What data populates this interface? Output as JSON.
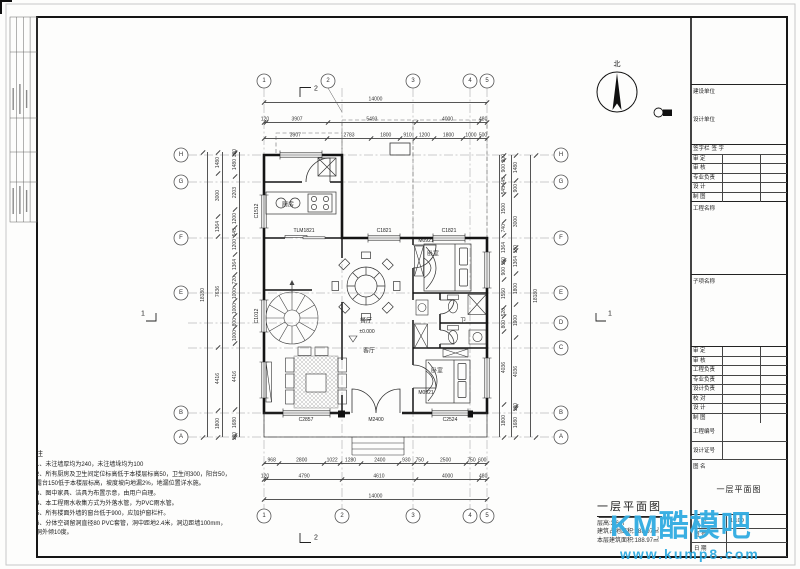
{
  "north_label": "北",
  "section_marks": {
    "top": "2",
    "bottom": "2",
    "left": "1",
    "right": "1"
  },
  "grid": {
    "top": [
      "1",
      "2",
      "3",
      "4",
      "5"
    ],
    "bottom": [
      "1",
      "2",
      "3",
      "4",
      "5"
    ],
    "left": [
      "H",
      "G",
      "F",
      "E",
      "B",
      "A"
    ],
    "right": [
      "H",
      "G",
      "F",
      "E",
      "D",
      "C",
      "B",
      "A"
    ]
  },
  "dims": {
    "top1": [
      "14000"
    ],
    "top2": [
      "120",
      "3907",
      "5493",
      "4000",
      "480"
    ],
    "top3": [
      "3907",
      "2783",
      "1800",
      "910",
      "1200",
      "1800",
      "1000",
      "500"
    ],
    "bottom1": [
      "968",
      "2800",
      "1022",
      "1280",
      "2400",
      "930",
      "750",
      "2500",
      "750",
      "600"
    ],
    "bottom2": [
      "120",
      "4790",
      "4610",
      "4000",
      "480"
    ],
    "bottom3": [
      "14000"
    ],
    "left_outer": [
      "18180"
    ],
    "left_mid": [
      "1480",
      "3000",
      "1364",
      "7636",
      "4416",
      "1800"
    ],
    "left_inner": [
      "120",
      "1480",
      "2203",
      "1200",
      "545",
      "1200",
      "1364",
      "720",
      "1000",
      "1000",
      "800",
      "1000",
      "4416",
      "1680",
      "120"
    ],
    "right_inner": [
      "300",
      "900",
      "445",
      "545",
      "1500",
      "740",
      "1364",
      "150",
      "900",
      "1550",
      "520",
      "800",
      "4036",
      "1800"
    ],
    "right_mid": [
      "1480",
      "900",
      "3000",
      "180",
      "1364",
      "1800",
      "1900",
      "4036",
      "120",
      "1680"
    ],
    "right_outer": [
      "18180"
    ]
  },
  "plan_labels": {
    "tlm1821": "TLM1821",
    "c1821a": "C1821",
    "c1821b": "C1821",
    "m0921a": "M0921",
    "m0921b": "M0921",
    "c2857": "C2857",
    "m2400": "M2400",
    "c2524": "C2524",
    "c1512": "C1512",
    "c1012": "C1012",
    "level": "±0.000"
  },
  "rooms": {
    "kitchen": "厨房",
    "dining": "餐厅",
    "living": "客厅",
    "bed1": "卧室",
    "bed2": "卧室",
    "bath": "卫"
  },
  "notes": {
    "title": "注",
    "items": [
      "1、未注墙厚均为240，未注墙垛均为100",
      "2、所有厨房及卫生间定位标高低于本楼层标高50，卫生间300，阳台50，露台150低于本楼层标高，坡度坡向地漏2%，地漏位置详水施。",
      "3、图中家具、洁具为布置示意，由用户自理。",
      "4、本工程雨水收集方式为外落水管，为PVC雨水管。",
      "5、所有楼面外墙的窗台低于900，应加护窗栏杆。",
      "6、分体空调留洞直径80 PVC套管，洞中距地2.4米，洞边距墙100mm，洞外倾10度。"
    ]
  },
  "drawing_title": {
    "name": "一层平面图",
    "line1": "层高:3.6m",
    "line2": "建筑占地面积:188.97㎡",
    "line3": "本层建筑面积:188.97㎡"
  },
  "titleblock": {
    "owner_label": "建设单位",
    "designer_label": "设计单位",
    "sign_header": [
      "签字栏",
      "签 字",
      ""
    ],
    "sign_rows": [
      "审 定",
      "审 核",
      "专业负责",
      "设 计",
      "制 图"
    ],
    "project_label": "工程名称",
    "subproject_label": "子项名称",
    "staff_rows": [
      "审 定",
      "审 核",
      "工程负责",
      "专业负责",
      "设计负责",
      "校 对",
      "设 计",
      "制 图"
    ],
    "extra_rows": [
      "工程编号",
      "设计证号"
    ],
    "figure_label": "图 名",
    "figure_name": "一层平面图",
    "meta_rows": [
      {
        "label": "比 例",
        "value": "1:100"
      },
      {
        "label": "图 号",
        "value": ""
      },
      {
        "label": "日 期",
        "value": ""
      }
    ]
  },
  "watermark": {
    "brand": "KM酷模吧",
    "url": "www.kump8.com",
    "color": "#29a8e0"
  }
}
